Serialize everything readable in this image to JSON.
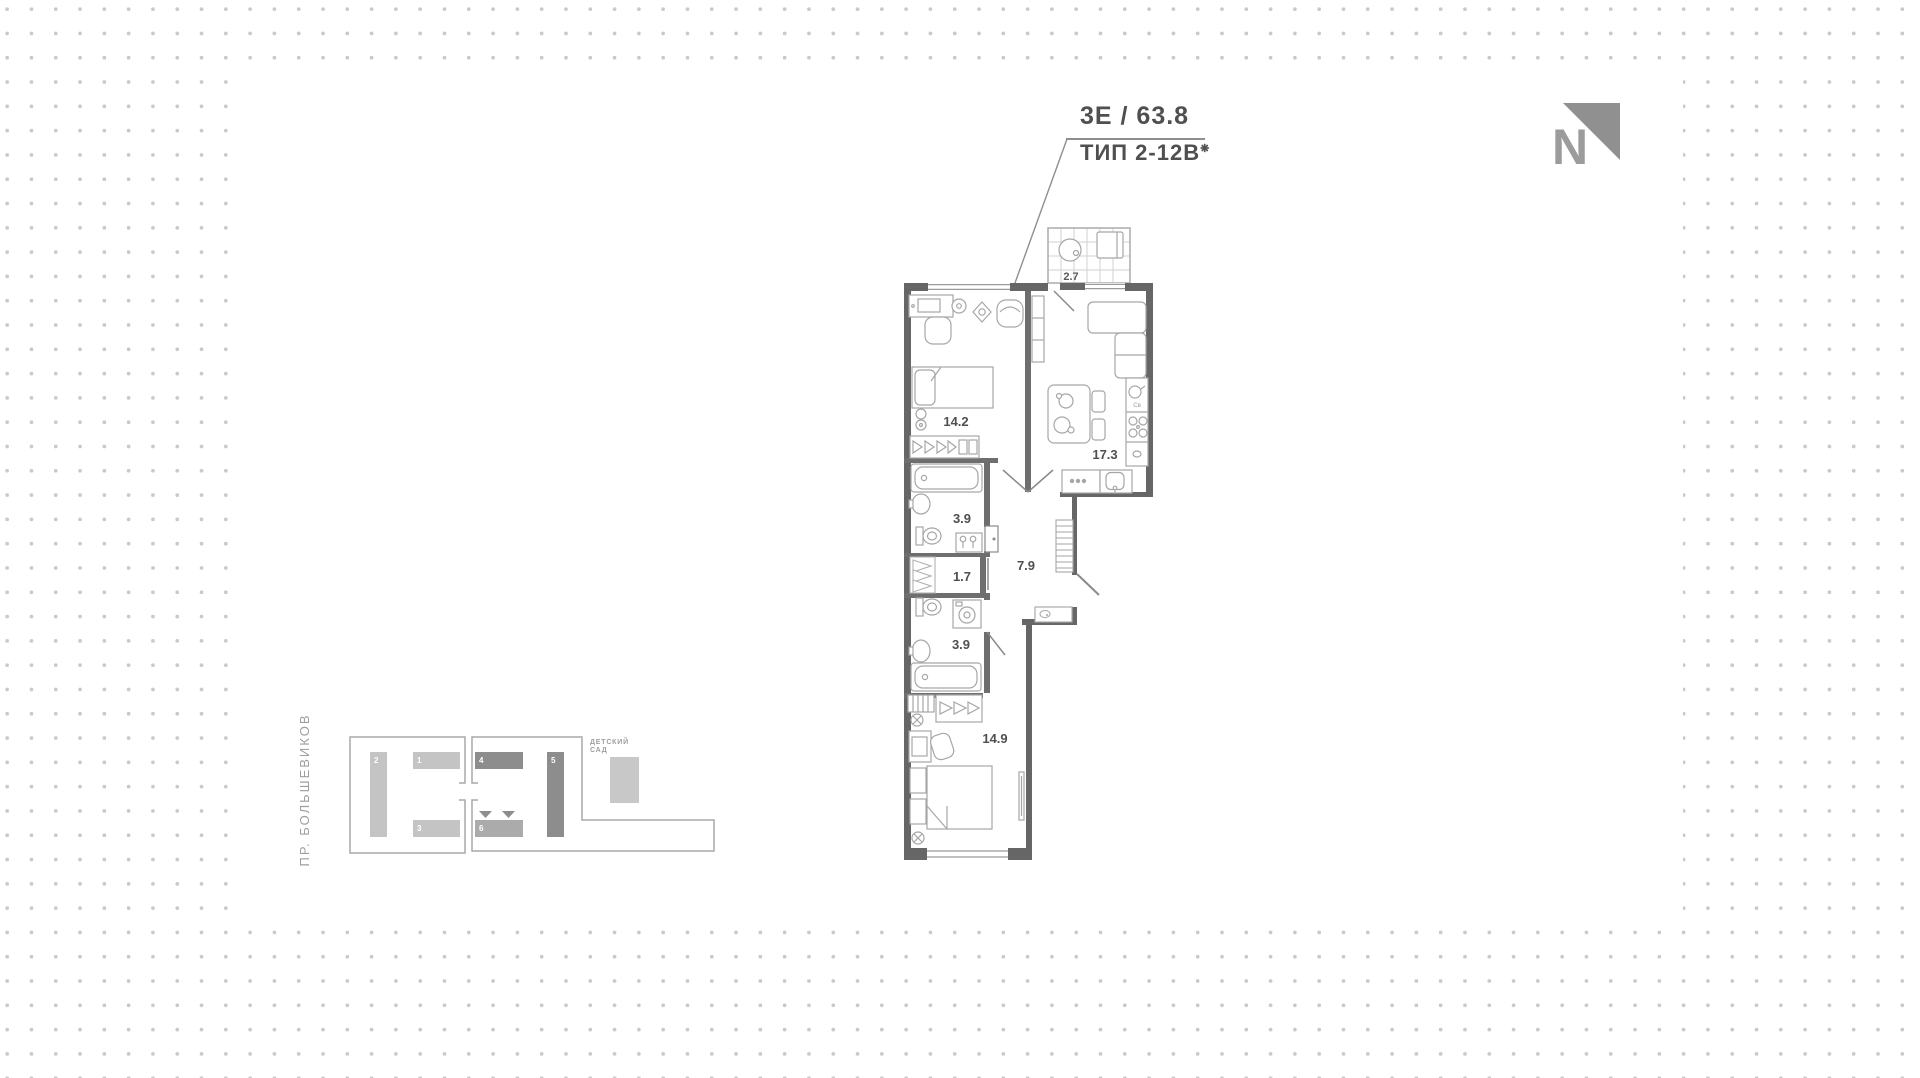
{
  "header": {
    "type_label": "3Е / 63.8",
    "plan_type": "ТИП 2-12В",
    "plan_type_mark": "❋"
  },
  "north_arrow": {
    "label": "N"
  },
  "floor_plan": {
    "rooms": [
      {
        "name": "balcony",
        "area": "2.7"
      },
      {
        "name": "bedroom-1",
        "area": "14.2"
      },
      {
        "name": "kitchen-living",
        "area": "17.3"
      },
      {
        "name": "bathroom-1",
        "area": "3.9"
      },
      {
        "name": "storage",
        "area": "1.7"
      },
      {
        "name": "hallway",
        "area": "7.9"
      },
      {
        "name": "bathroom-2",
        "area": "3.9"
      },
      {
        "name": "bedroom-2",
        "area": "14.9"
      }
    ],
    "appliance_label": "Св"
  },
  "site_plan": {
    "street": "ПР. БОЛЬШЕВИКОВ",
    "landmark_line1": "ДЕТСКИЙ",
    "landmark_line2": "САД",
    "buildings": [
      {
        "label": "1"
      },
      {
        "label": "2"
      },
      {
        "label": "3"
      },
      {
        "label": "4"
      },
      {
        "label": "5"
      },
      {
        "label": "6"
      }
    ]
  },
  "colors": {
    "wall": "#666666",
    "furniture_line": "#a6a6a6",
    "dots": "#c9c9c9",
    "building_light": "#c4c4c4",
    "building_dark": "#8d8d8d",
    "building_mid": "#ababab",
    "text_gray": "#9e9e9e",
    "title_text": "#4f4f4f"
  }
}
